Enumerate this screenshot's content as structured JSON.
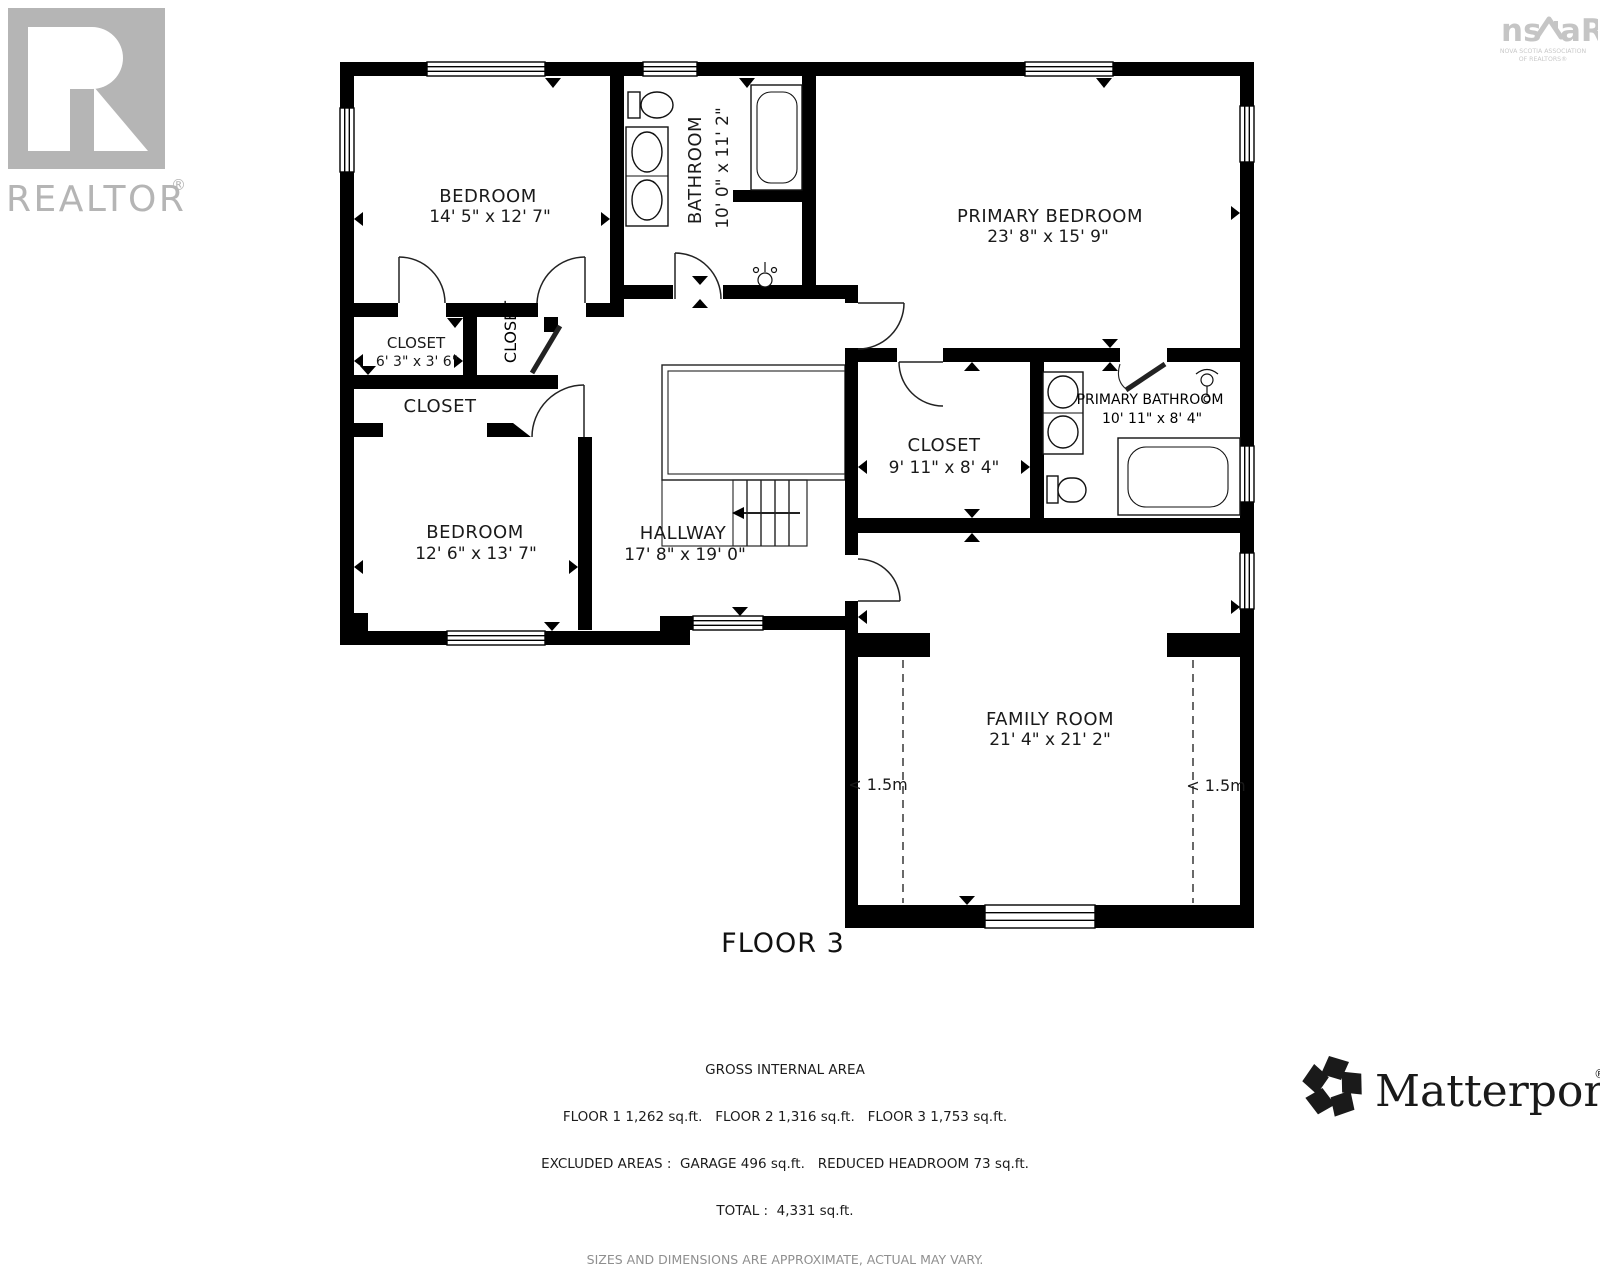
{
  "page": {
    "floor_title": "FLOOR 3"
  },
  "rooms": {
    "bedroom1": {
      "name": "BEDROOM",
      "dims": "14' 5\" x 12' 7\""
    },
    "bathroom": {
      "name": "BATHROOM",
      "dims": "10' 0\" x 11' 2\""
    },
    "primary_bedroom": {
      "name": "PRIMARY BEDROOM",
      "dims": "23' 8\" x 15' 9\""
    },
    "closet_small": {
      "name": "CLOSET",
      "dims": "6' 3\" x 3' 6\""
    },
    "closet_vertical": {
      "name": "CLOSET"
    },
    "closet_wide": {
      "name": "CLOSET"
    },
    "bedroom2": {
      "name": "BEDROOM",
      "dims": "12' 6\" x 13' 7\""
    },
    "hallway": {
      "name": "HALLWAY",
      "dims": "17' 8\" x 19' 0\""
    },
    "closet_primary": {
      "name": "CLOSET",
      "dims": "9' 11\" x 8' 4\""
    },
    "primary_bathroom": {
      "name": "PRIMARY BATHROOM",
      "dims": "10' 11\" x 8' 4\""
    },
    "family_room": {
      "name": "FAMILY ROOM",
      "dims": "21' 4\" x 21' 2\""
    }
  },
  "annotations": {
    "headroom_left": "< 1.5m",
    "headroom_right": "< 1.5m"
  },
  "footer": {
    "line1": "GROSS INTERNAL AREA",
    "line2": "FLOOR 1 1,262 sq.ft.   FLOOR 2 1,316 sq.ft.   FLOOR 3 1,753 sq.ft.",
    "line3": "EXCLUDED AREAS :  GARAGE 496 sq.ft.   REDUCED HEADROOM 73 sq.ft.",
    "line4": "TOTAL :  4,331 sq.ft.",
    "line5": "SIZES AND DIMENSIONS ARE APPROXIMATE, ACTUAL MAY VARY."
  },
  "branding": {
    "realtor_text": "REALTOR",
    "realtor_reg": "®",
    "nsar_left": "ns",
    "nsar_right": "aR",
    "nsar_sub1": "NOVA SCOTIA ASSOCIATION",
    "nsar_sub2": "OF REALTORS®",
    "matterport_text": "Matterport",
    "matterport_reg": "®"
  },
  "colors": {
    "wall": "#000000",
    "label_text": "#1a1a1a",
    "logo_grey": "#b5b5b5",
    "footer_grey": "#8f8f8f"
  }
}
